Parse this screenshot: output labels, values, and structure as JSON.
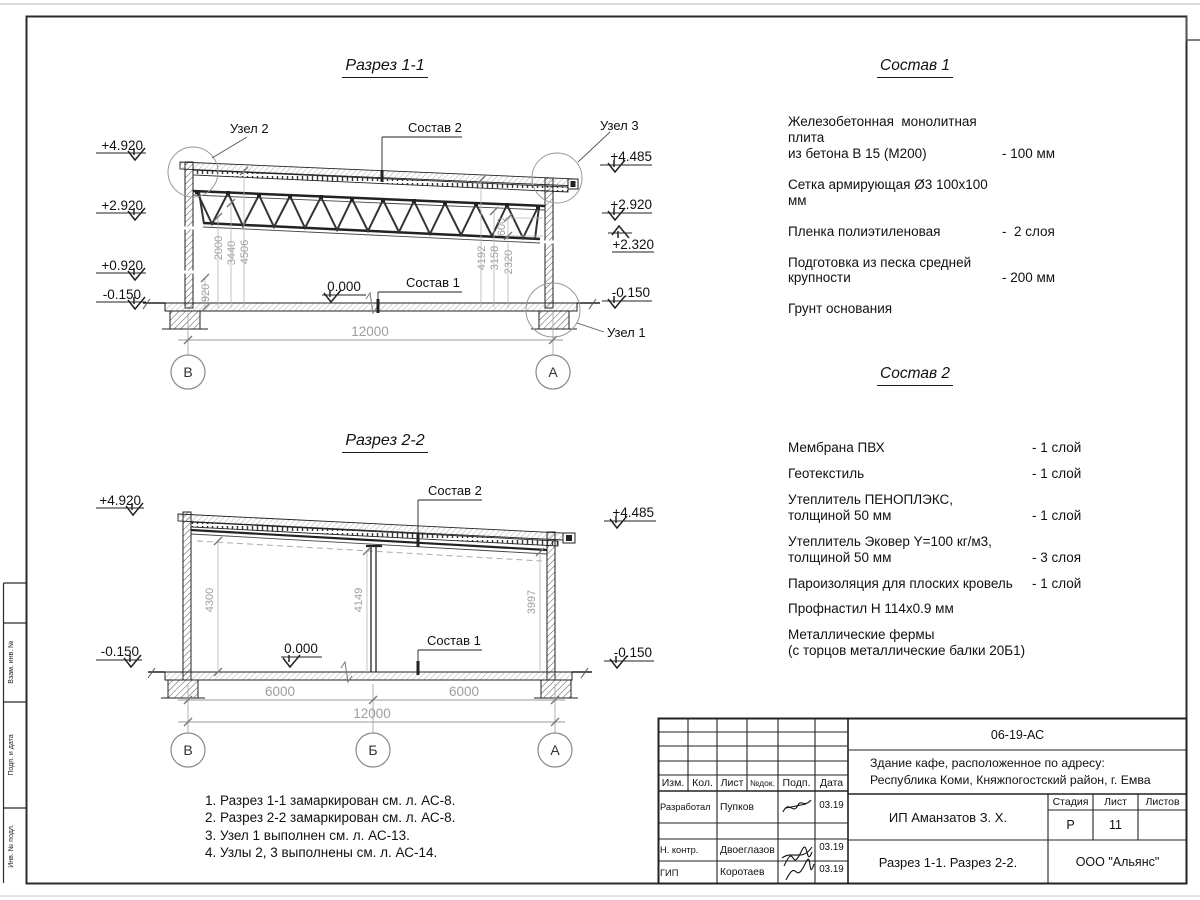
{
  "section1": {
    "title": "Разрез 1-1",
    "labels": {
      "uzel2": "Узел 2",
      "uzel3": "Узел 3",
      "uzel1": "Узел 1",
      "sostav2": "Состав 2",
      "sostav1": "Состав 1",
      "zero": "0.000"
    },
    "elev_left": [
      "+4.920",
      "+2.920",
      "+0.920",
      "-0.150"
    ],
    "elev_right": [
      "+4.485",
      "+2.920",
      "+2.320",
      "-0.150"
    ],
    "dims_left": [
      "920",
      "2000",
      "3440",
      "4506"
    ],
    "dims_right": [
      "600",
      "4192",
      "3158",
      "2320"
    ],
    "dim_span": "12000",
    "axes": [
      "В",
      "А"
    ]
  },
  "section2": {
    "title": "Разрез 2-2",
    "labels": {
      "sostav2": "Состав 2",
      "sostav1": "Состав 1",
      "zero": "0.000"
    },
    "elev_left": [
      "+4.920",
      "-0.150"
    ],
    "elev_right": [
      "+4.485",
      "-0.150"
    ],
    "dims_vert": [
      "4300",
      "4149",
      "3997"
    ],
    "dims_bottom": [
      "6000",
      "6000",
      "12000"
    ],
    "axes": [
      "В",
      "Б",
      "А"
    ]
  },
  "sostav1": {
    "title": "Состав 1",
    "items": [
      {
        "text": "Железобетонная  монолитная плита\nиз бетона В 15 (М200)",
        "qty": "- 100 мм"
      },
      {
        "text": "Сетка армирующая Ø3 100x100 мм",
        "qty": ""
      },
      {
        "text": "Пленка полиэтиленовая",
        "qty": "-  2 слоя"
      },
      {
        "text": "Подготовка из песка средней\nкрупности",
        "qty": "- 200 мм"
      },
      {
        "text": "Грунт основания",
        "qty": ""
      }
    ]
  },
  "sostav2": {
    "title": "Состав 2",
    "items": [
      {
        "text": "Мембрана ПВХ",
        "qty": "- 1 слой"
      },
      {
        "text": "Геотекстиль",
        "qty": "- 1 слой"
      },
      {
        "text": "Утеплитель ПЕНОПЛЭКС,\nтолщиной 50 мм",
        "qty": "- 1 слой"
      },
      {
        "text": "Утеплитель Эковер Y=100 кг/м3,\nтолщиной 50 мм",
        "qty": "- 3 слоя"
      },
      {
        "text": "Пароизоляция для плоских кровель",
        "qty": "- 1 слой"
      },
      {
        "text": "Профнастил Н 114x0.9 мм",
        "qty": ""
      },
      {
        "text": "Металлические фермы\n(с торцов металлические балки 20Б1)",
        "qty": ""
      }
    ]
  },
  "notes": [
    "1. Разрез 1-1 замаркирован см. л. АС-8.",
    "2. Разрез 2-2 замаркирован см. л. АС-8.",
    "3. Узел 1 выполнен см. л. АС-13.",
    "4. Узлы 2, 3 выполнены см. л. АС-14."
  ],
  "titleblock": {
    "doc_number": "06-19-АС",
    "project": "Здание кафе, расположенное по адресу:\nРеспублика Коми, Княжпогостский район, г. Емва",
    "cols": {
      "izm": "Изм.",
      "kol": "Кол.",
      "list": "Лист",
      "ndoc": "№док.",
      "podp": "Подп.",
      "data": "Дата"
    },
    "rows": [
      {
        "role": "Разработал",
        "name": "Пупков",
        "date": "03.19"
      },
      {
        "role": "Н. контр.",
        "name": "Двоеглазов",
        "date": "03.19"
      },
      {
        "role": "ГИП",
        "name": "Коротаев",
        "date": "03.19"
      }
    ],
    "client": "ИП Аманзатов З. Х.",
    "stage_label": "Стадия",
    "sheet_label": "Лист",
    "sheets_label": "Листов",
    "stage": "Р",
    "sheet": "11",
    "sheets": "",
    "sheet_title": "Разрез 1-1. Разрез 2-2.",
    "company": "ООО \"Альянс\""
  },
  "margin_stamps": [
    "Взам. инв. №",
    "Подп. и дата",
    "Инв. № подл."
  ]
}
